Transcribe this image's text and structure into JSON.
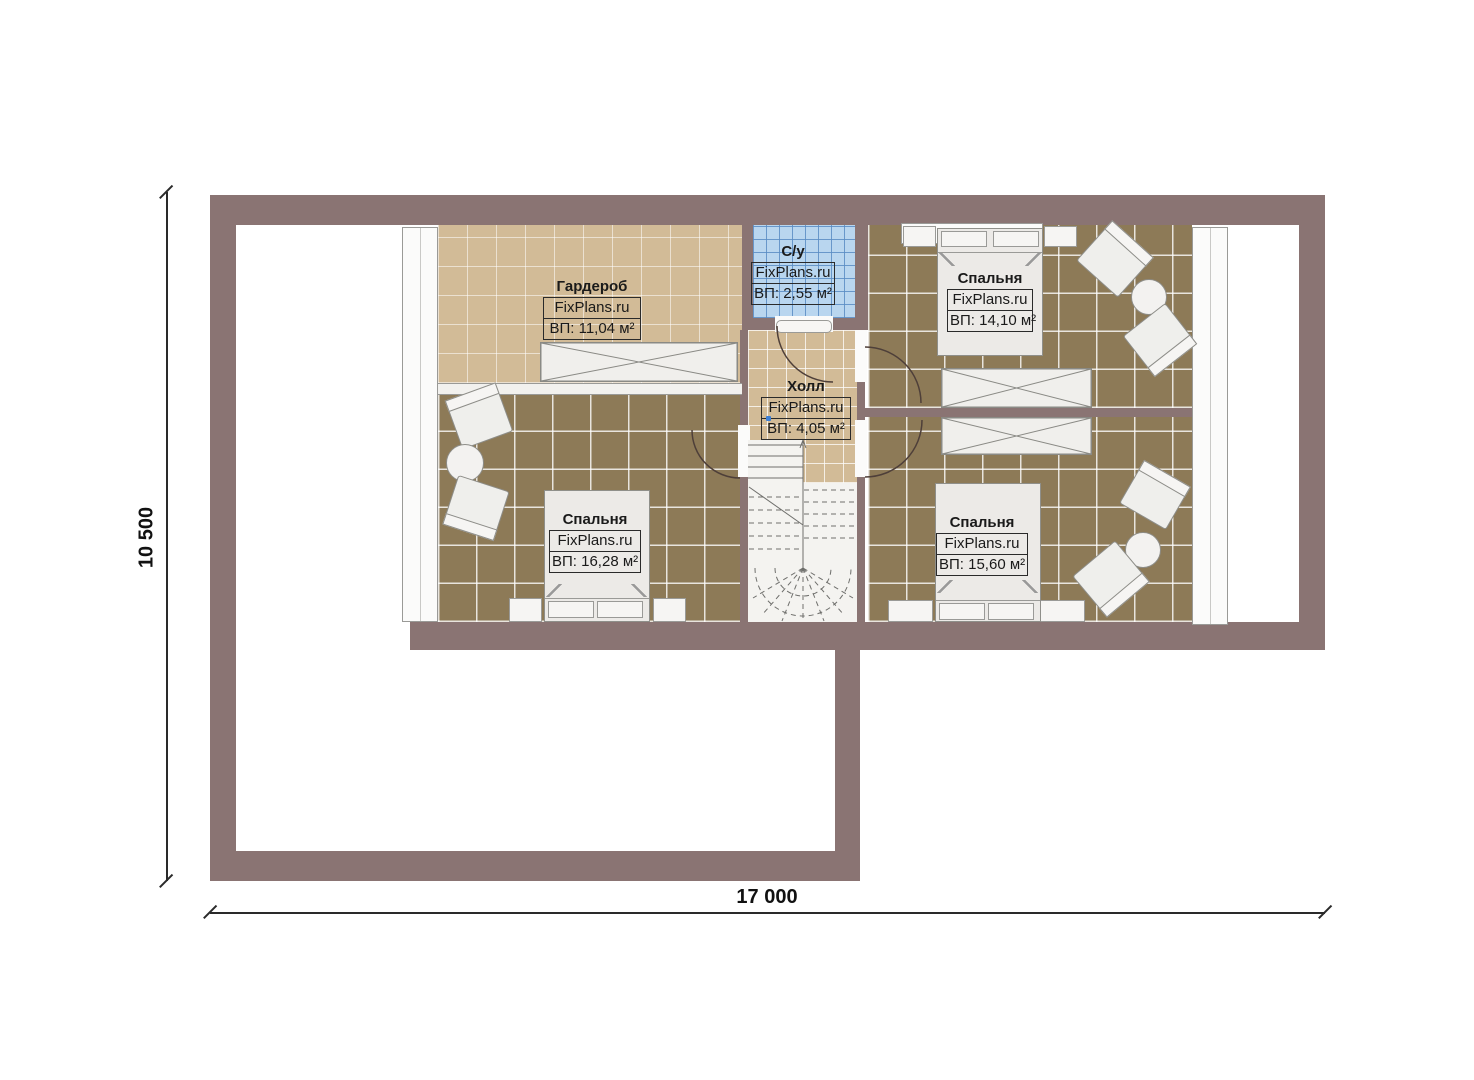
{
  "rooms": [
    {
      "id": "wardrobe",
      "name": "Гардероб",
      "brand": "FixPlans.ru",
      "area": "ВП: 11,04 м²"
    },
    {
      "id": "bathroom",
      "name": "С/у",
      "brand": "FixPlans.ru",
      "area": "ВП: 2,55 м²"
    },
    {
      "id": "hall",
      "name": "Холл",
      "brand": "FixPlans.ru",
      "area": "ВП: 4,05 м²"
    },
    {
      "id": "bedroom-top-right",
      "name": "Спальня",
      "brand": "FixPlans.ru",
      "area": "ВП: 14,10 м²"
    },
    {
      "id": "bedroom-bottom-left",
      "name": "Спальня",
      "brand": "FixPlans.ru",
      "area": "ВП: 16,28 м²"
    },
    {
      "id": "bedroom-bottom-right",
      "name": "Спальня",
      "brand": "FixPlans.ru",
      "area": "ВП: 15,60 м²"
    }
  ],
  "dimensions": {
    "vertical_label": "10 500",
    "horizontal_label": "17 000"
  },
  "colors": {
    "wall": "#8a7473",
    "floor_beige": "#d2bb97",
    "floor_dark_tile": "#8d7a57",
    "floor_blue_tile": "#b9d6ef",
    "furniture": "#eceae7",
    "dimension_line": "#2a2a2a",
    "hall_marker_dot": "#3d7fd4"
  }
}
